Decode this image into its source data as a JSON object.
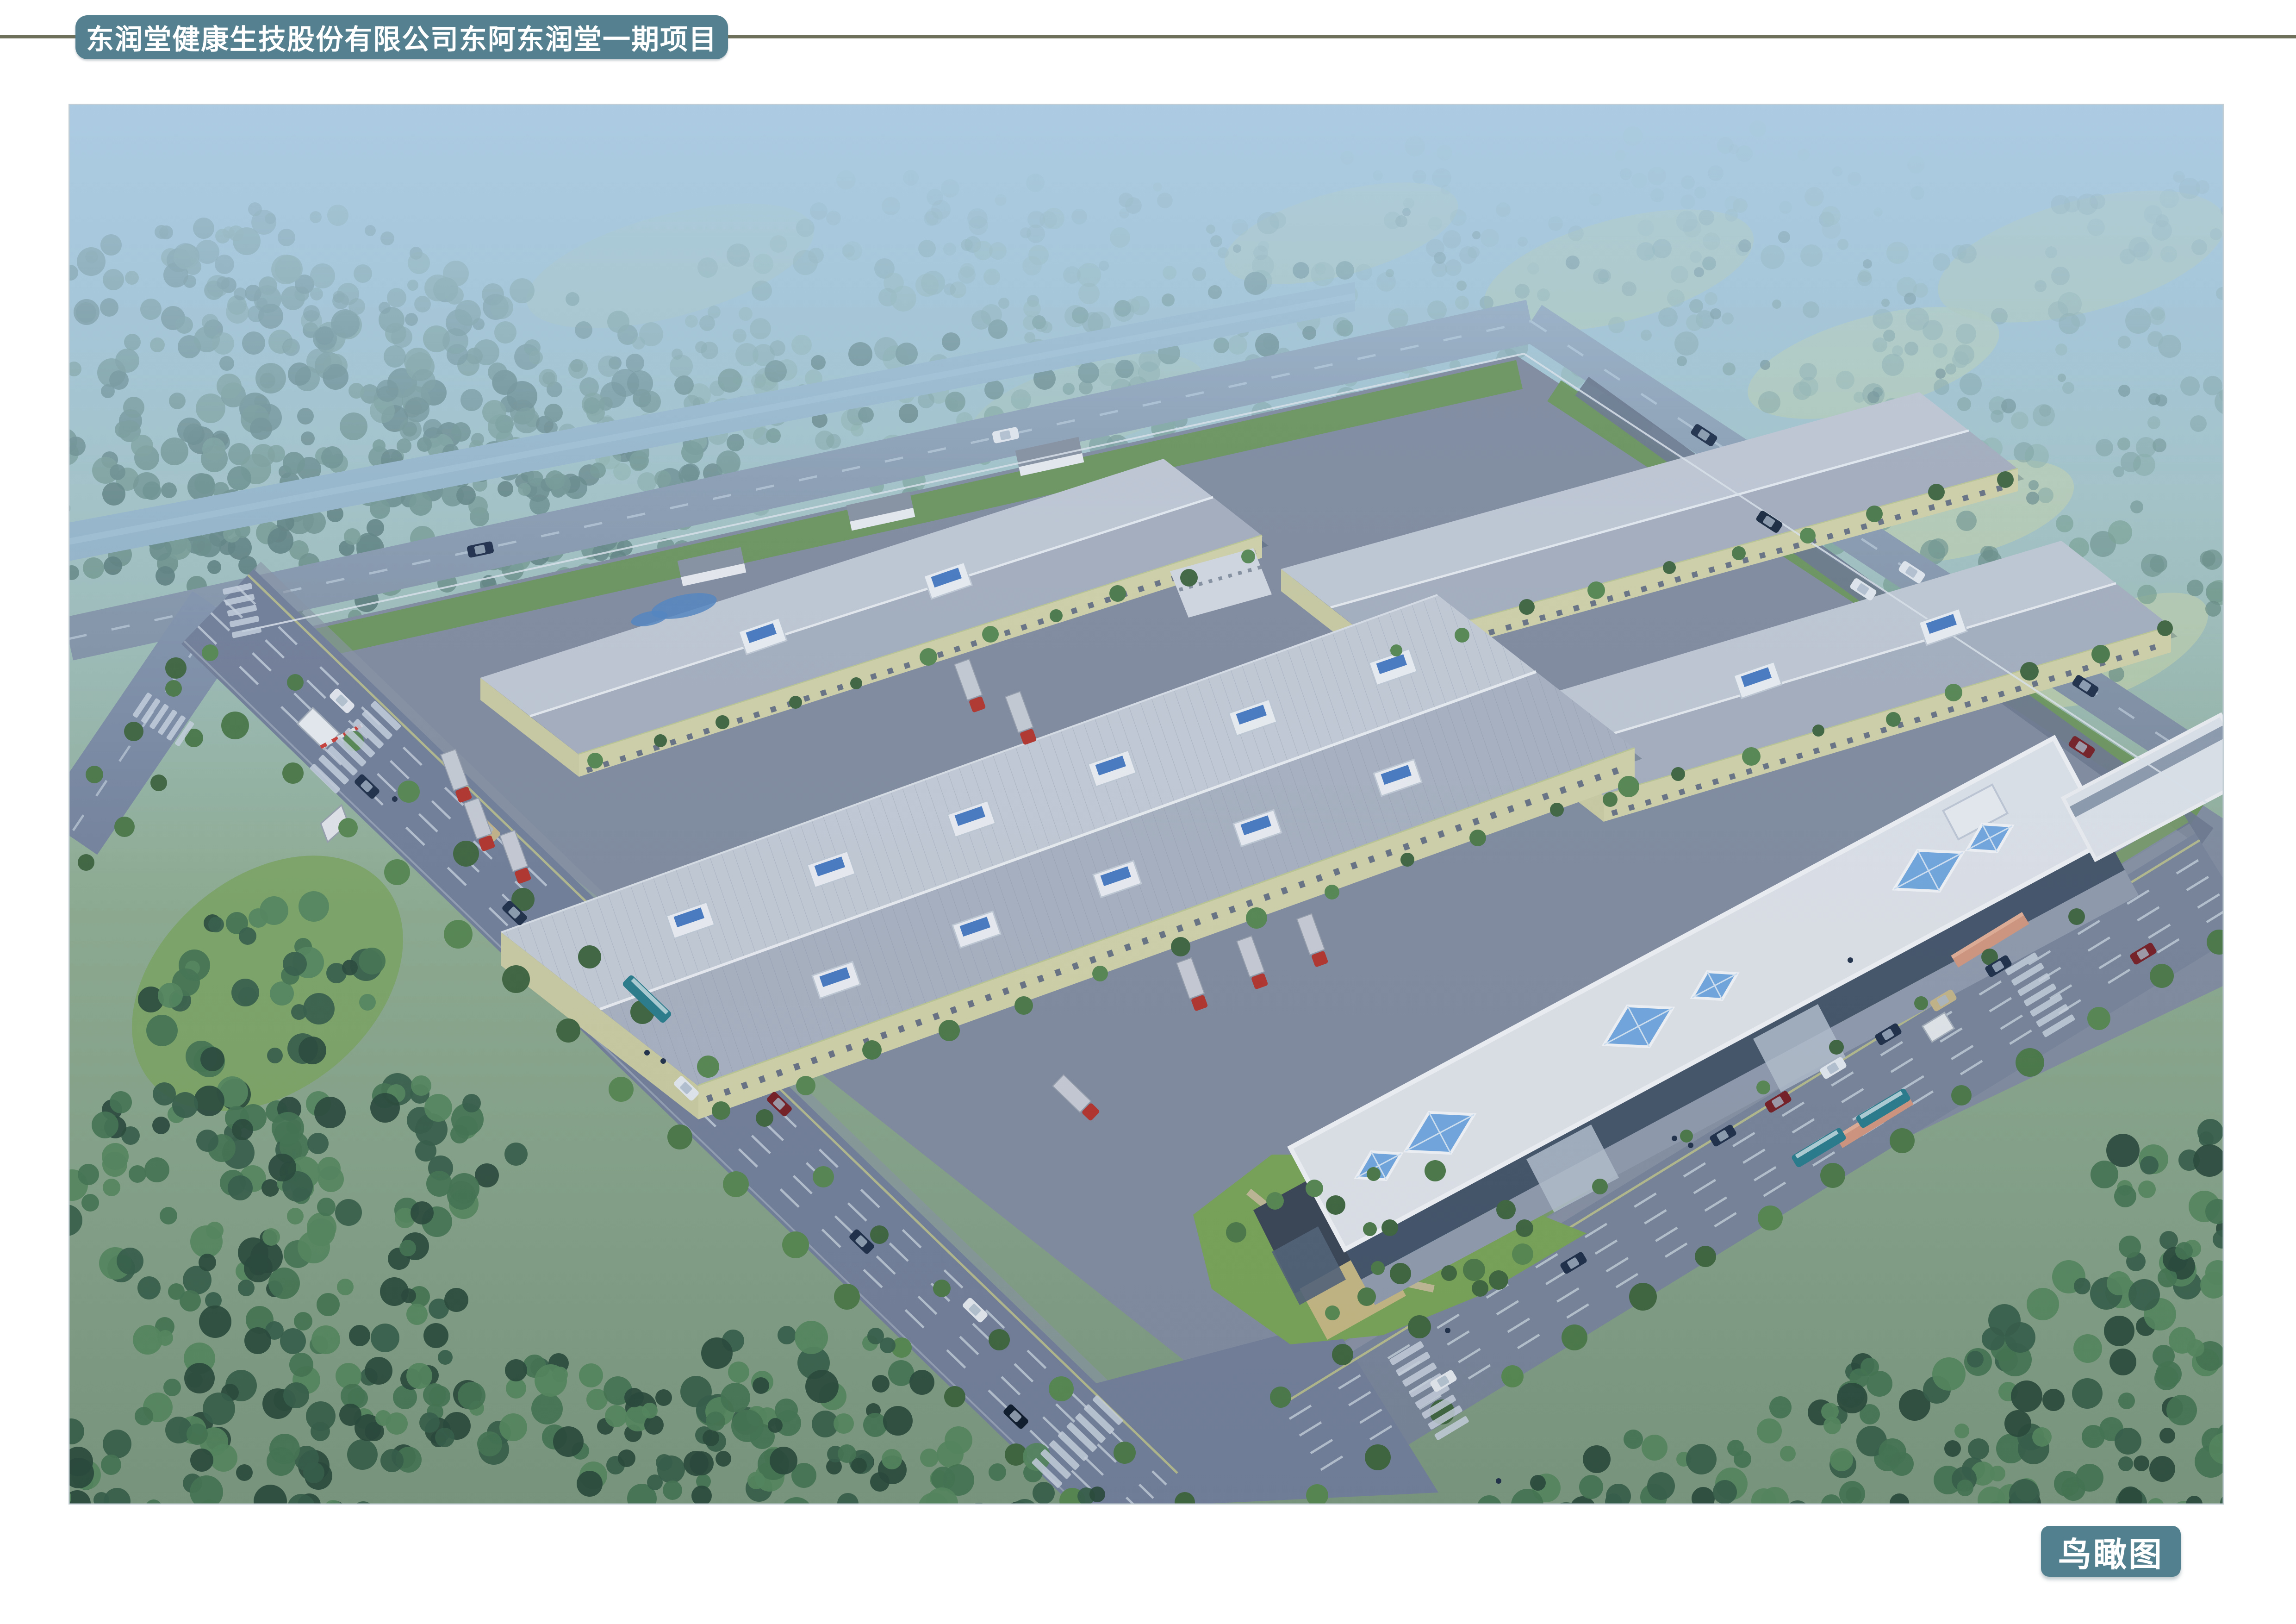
{
  "header": {
    "title": "东润堂健康生技股份有限公司东阿东润堂一期项目"
  },
  "caption": {
    "label": "鸟瞰图"
  },
  "palette": {
    "badge_teal": "#54808F",
    "rule_olive": "#6F705B",
    "sky_haze_blue": "#97C2DD",
    "far_forest_green": "#456A5C",
    "near_forest_green": "#2B4C3C",
    "road_slate": "#76829B",
    "roof_gray": "#C9D0DA",
    "wall_cream": "#D6D7AB",
    "eave_trim": "#C2CC96",
    "pond_turquoise": "#5CC8D3",
    "office_white": "#E4E8ED",
    "skylight_blue": "#74ABE2",
    "truck_red": "#B8352C",
    "bus_teal": "#2A7F8E",
    "gate_salmon": "#D79A80"
  }
}
